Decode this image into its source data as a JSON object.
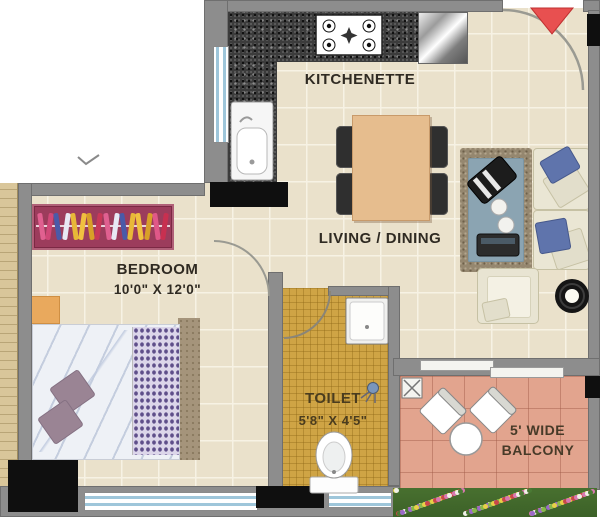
{
  "plan": {
    "rooms": {
      "kitchenette": {
        "label": "KITCHENETTE"
      },
      "living_dining": {
        "label": "LIVING / DINING"
      },
      "bedroom": {
        "label": "BEDROOM",
        "dimensions": "10'0\" X 12'0\""
      },
      "toilet": {
        "label": "TOILET",
        "dimensions": "5'8\" X 4'5\""
      },
      "balcony": {
        "label_line1": "5' WIDE",
        "label_line2": "BALCONY"
      }
    },
    "fixtures": [
      "gas-stove",
      "kitchen-sink",
      "refrigerator",
      "dining-table",
      "sofa",
      "armchair",
      "coffee-table",
      "round-side-table",
      "wardrobe",
      "double-bed",
      "wash-basin",
      "wc-toilet",
      "shower-head",
      "balcony-chairs",
      "balcony-table",
      "floor-drain",
      "entrance-marker",
      "door-swing-arcs",
      "flower-bed"
    ],
    "colors": {
      "entrance_marker": "#e04840",
      "floor_tile": "#eae1cb",
      "toilet_floor": "#cfa445",
      "balcony_floor": "#e2a48e",
      "granite_counter": "#3c3c3c",
      "wall": "#8d8d8d"
    },
    "wardrobe_clothes_colors": [
      "#e06090",
      "#d04878",
      "#4a5aa8",
      "#e8e8f4",
      "#e8b838",
      "#f0c040",
      "#d8a028",
      "#c83858",
      "#e06090",
      "#e8e8f4",
      "#4a5aa8",
      "#e8b838",
      "#f0c040",
      "#d8a028",
      "#e05888",
      "#c83050"
    ],
    "flower_colors": [
      "#e8d048",
      "#9a6ac8",
      "#f0f0e8",
      "#c84848",
      "#88b848",
      "#4a7a34",
      "#d878b0"
    ]
  }
}
